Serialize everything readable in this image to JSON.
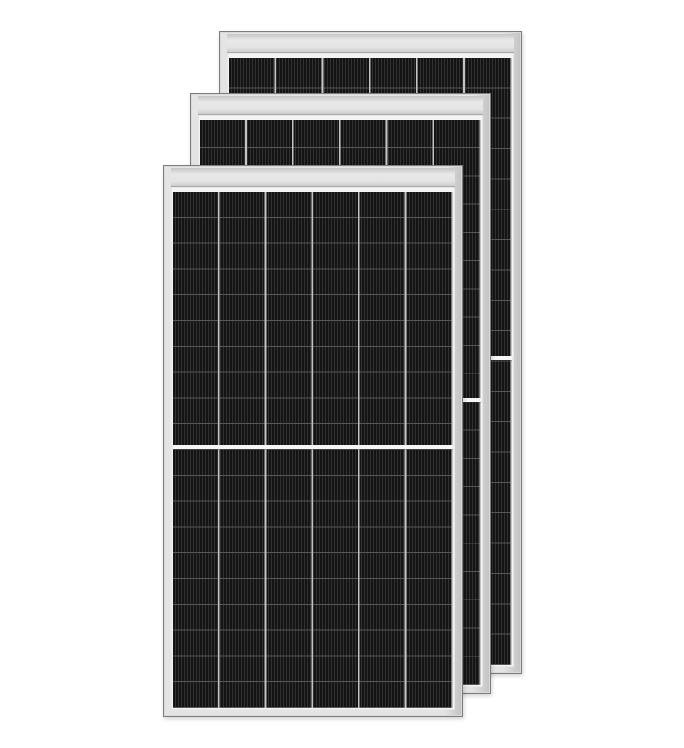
{
  "scene": {
    "type": "product-image",
    "subject": "Three black monocrystalline half-cut solar panels with silver aluminum frames, stacked in an overlapping cascade on a white background",
    "background_color": "#ffffff",
    "panel_count": 3
  },
  "panel_style": {
    "columns": 6,
    "rows_total": 20,
    "frame_color": "#e4e4e4",
    "frame_outline_color": "#7d7d7d",
    "frame_side_shade_color": "#c2c2c2",
    "top_band_top_color": "#c6c6c6",
    "top_band_main_color": "#e9e9e9",
    "top_band_edge_color": "#a9a9a9",
    "backsheet_color": "#f4f4f4",
    "cell_base_color": "#1b1b1b",
    "cell_stripe_dark_color": "#141414",
    "cell_stripe_light_color": "#313131",
    "column_separator_color": "#c4c4c4",
    "row_line_color": "#565656",
    "center_divider_color": "#f5f5f5",
    "frame_side_px": 7,
    "frame_bottom_px": 6,
    "top_band_px": 18,
    "cells_top_offset_px": 21,
    "divider_height_px": 4,
    "divider_position_pct": 49.5
  },
  "panels": [
    {
      "id": "back",
      "x": 219,
      "y": 31,
      "width": 303,
      "height": 643,
      "z": 1
    },
    {
      "id": "middle",
      "x": 190,
      "y": 93,
      "width": 301,
      "height": 601,
      "z": 2
    },
    {
      "id": "front",
      "x": 163,
      "y": 165,
      "width": 300,
      "height": 552,
      "z": 3
    }
  ]
}
